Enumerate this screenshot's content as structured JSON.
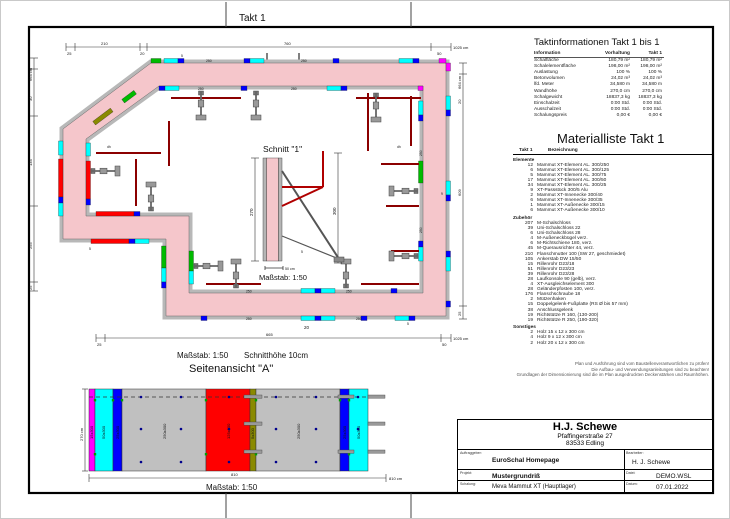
{
  "page": {
    "takt_header": "Takt 1"
  },
  "colors": {
    "concrete_pink": "#f5c6cb",
    "formwork_gray": "#b8b8b8",
    "element_250": "#c0c0c0",
    "element_125": "#ff0000",
    "element_75": "#00bb00",
    "element_50": "#00ffff",
    "element_25": "#0000ff",
    "passstueck": "#8a8a00",
    "corner_element": "#ff00ff",
    "rail_darkred": "#8b0000",
    "brace_gray": "#777777"
  },
  "plan": {
    "section_marker": "\"1\"",
    "view_marker": "\"A\"",
    "marker_sub": "15",
    "dim_top": {
      "s1": "25",
      "s2": "210",
      "s3": "20",
      "s4": "760",
      "s5": "50",
      "total": "1025 cm"
    },
    "dim_bottom": {
      "s1": "25",
      "s2": "665",
      "s3": "50",
      "total": "1025 cm"
    },
    "dim_left": {
      "total": "664 cm",
      "s1": "30",
      "s2": "134",
      "s3": "255",
      "s4": "25"
    },
    "dim_right": {
      "total": "664 cm",
      "s1": "20",
      "s2": "609",
      "s3": "25"
    },
    "labels": {
      "panel_250": "250",
      "small_20": "20",
      "small_5": "5",
      "dh": "dh",
      "nine": "9"
    }
  },
  "schnitt": {
    "title": "Schnitt \"1\"",
    "dim_height": "270",
    "dim_right": "300",
    "scale_bar": "50 cm",
    "scale": "Maßstab: 1:50"
  },
  "sideview": {
    "scale_note": "Maßstab: 1:50",
    "cut_height_note": "Schnitthöhe 10cm",
    "title": "Seitenansicht \"A\"",
    "height_dim": "270 cm",
    "dim_total": "810",
    "dim_total_label": "810 cm",
    "scale_bottom": "Maßstab: 1:50",
    "panels": [
      {
        "label": "15x300",
        "color": "#ff00ff"
      },
      {
        "label": "50x300",
        "color": "#00ffff"
      },
      {
        "label": "25x300",
        "color": "#0000ff"
      },
      {
        "label": "250x300",
        "color": "#c0c0c0"
      },
      {
        "label": "125x300",
        "color": "#ff0000"
      },
      {
        "label": "5x300",
        "color": "#8a8a00"
      },
      {
        "label": "250x300",
        "color": "#c0c0c0"
      },
      {
        "label": "25x300",
        "color": "#0000ff"
      },
      {
        "label": "50x300",
        "color": "#00ffff"
      }
    ]
  },
  "taktinfo": {
    "title": "Taktinformationen  Takt 1 bis 1",
    "col_info": "Information",
    "col_vorhaltung": "Vorhaltung",
    "col_takt": "Takt 1",
    "rows": [
      {
        "info": "Schalfläche",
        "vorhaltung": "180,79 m²",
        "takt1": "180,79 m²"
      },
      {
        "info": "Schalelementfläche",
        "vorhaltung": "198,00 m²",
        "takt1": "198,00 m²"
      },
      {
        "info": "Auslastung",
        "vorhaltung": "100 %",
        "takt1": "100 %"
      },
      {
        "info": "Betonvolumen",
        "vorhaltung": "24,02 m³",
        "takt1": "24,02 m³"
      },
      {
        "info": "lfd. Meter",
        "vorhaltung": "34,580 m",
        "takt1": "34,580 m"
      },
      {
        "info": "Wandhöhe",
        "vorhaltung": "270,0 cm",
        "takt1": "270,0 cm"
      },
      {
        "info": "Schalgewicht",
        "vorhaltung": "18837,3 kg",
        "takt1": "18837,3 kg"
      },
      {
        "info": "Einschalzeit",
        "vorhaltung": "0:00 Std.",
        "takt1": "0:00 Std."
      },
      {
        "info": "Ausschalzeit",
        "vorhaltung": "0:00 Std.",
        "takt1": "0:00 Std."
      },
      {
        "info": "Schalungspreis",
        "vorhaltung": "0,00 €",
        "takt1": "0,00 €"
      }
    ]
  },
  "materialliste": {
    "title": "Materialliste  Takt 1",
    "col_takt": "Takt 1",
    "col_bezeichnung": "Bezeichnung",
    "groups": [
      {
        "name": "Elemente",
        "items": [
          {
            "qty": "12",
            "name": "Mammut XT-Element AL. 300/250"
          },
          {
            "qty": "6",
            "name": "Mammut XT-Element AL. 300/125"
          },
          {
            "qty": "5",
            "name": "Mammut XT-Element AL. 300/75"
          },
          {
            "qty": "17",
            "name": "Mammut XT-Element AL. 300/50"
          },
          {
            "qty": "34",
            "name": "Mammut XT-Element AL. 300/25"
          },
          {
            "qty": "9",
            "name": "XT-Passstück 300/5 Alu"
          },
          {
            "qty": "2",
            "name": "Mammut XT-Innenecke 300/40"
          },
          {
            "qty": "6",
            "name": "Mammut XT-Innenecke 300/35"
          },
          {
            "qty": "1",
            "name": "Mammut XT-Außenecke 300/15"
          },
          {
            "qty": "6",
            "name": "Mammut XT-Außenecke 300/10"
          }
        ]
      },
      {
        "name": "Zubehör",
        "items": [
          {
            "qty": "207",
            "name": "M-Schalschloss"
          },
          {
            "qty": "39",
            "name": "Uni-Schalschloss 22"
          },
          {
            "qty": "6",
            "name": "Uni-Schalschloss 28"
          },
          {
            "qty": "4",
            "name": "M-Außeneckbügel verz."
          },
          {
            "qty": "6",
            "name": "M-Richtschiene 180, verz."
          },
          {
            "qty": "45",
            "name": "M-Querausrichter 44, verz."
          },
          {
            "qty": "210",
            "name": "Flanschmutter 100 (SW 27, geschmiedet)"
          },
          {
            "qty": "105",
            "name": "Ankerstab DW 15/50"
          },
          {
            "qty": "15",
            "name": "Rillenrohr D23/18"
          },
          {
            "qty": "51",
            "name": "Rillenrohr D23/23"
          },
          {
            "qty": "39",
            "name": "Rillenrohr D23/28"
          },
          {
            "qty": "28",
            "name": "Laufkonsole 90 (gelb), verz."
          },
          {
            "qty": "4",
            "name": "XT-Ausgleichselement 300"
          },
          {
            "qty": "28",
            "name": "Geländerpfosten 100, verz."
          },
          {
            "qty": "176",
            "name": "Flanschschraube 18"
          },
          {
            "qty": "2",
            "name": "Mützenhaken"
          },
          {
            "qty": "15",
            "name": "Doppelgelenk-Fußplatte (RS Ø bis 57 mm)"
          },
          {
            "qty": "38",
            "name": "Anschlussgelenk"
          },
          {
            "qty": "19",
            "name": "Richtstütze R 160, (130-200)"
          },
          {
            "qty": "19",
            "name": "Richtstütze R 250, (190-320)"
          }
        ]
      },
      {
        "name": "Sonstiges",
        "items": [
          {
            "qty": "2",
            "name": "Holz 15 x 12 x 300 cm"
          },
          {
            "qty": "4",
            "name": "Holz 9 x 12 x 300 cm"
          },
          {
            "qty": "2",
            "name": "Holz 20 x 12 x 300 cm"
          }
        ]
      }
    ]
  },
  "notes": {
    "line1": "Plan und Ausführung sind vom Baustellenverantwortlichen zu prüfen!",
    "line2": "Die Aufbau- und Verwendungsanleitungen sind zu beachten!",
    "line3": "Grundlagen der Dimensionierung sind die im Plan ausgedruckten Deckenstärken und Raumhöhen."
  },
  "titleblock": {
    "company": "H.J. Schewe",
    "street": "Pfaffingerstraße 27",
    "city": "83533 Edling",
    "auftraggeber_label": "Auftraggeber:",
    "auftraggeber": "EuroSchal Homepage",
    "bearbeiter_label": "Bearbeiter:",
    "bearbeiter": "H. J. Schewe",
    "projekt_label": "Projekt:",
    "projekt": "Mustergrundriß",
    "datei_label": "Datei:",
    "datei": "DEMO.WSL",
    "schalung_label": "Schalung:",
    "schalung": "Meva Mammut XT (Hauptlager)",
    "datum_label": "Datum:",
    "datum": "07.01.2022"
  }
}
